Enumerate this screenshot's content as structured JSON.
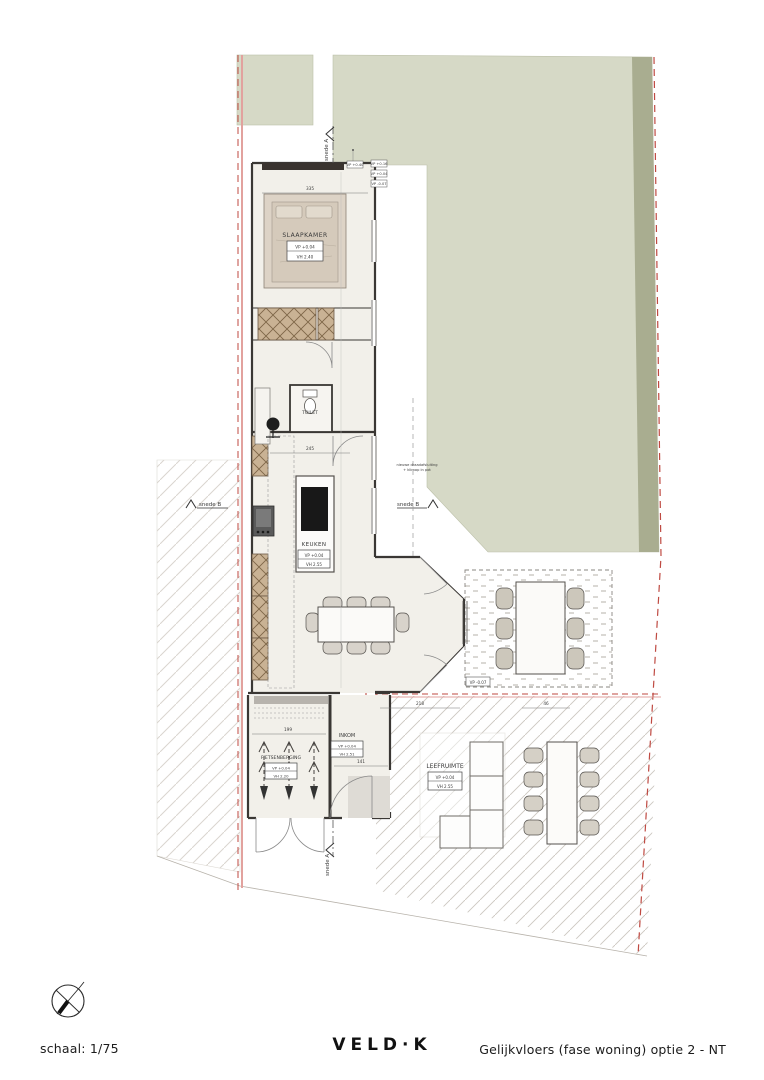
{
  "footer": {
    "scale_label": "schaal: 1/75",
    "logo": "VELD·K",
    "drawing_title": "Gelijkvloers (fase woning) optie 2 - NT"
  },
  "plan": {
    "rooms": {
      "slaapkamer": {
        "name": "SLAAPKAMER",
        "vp": "VP +0.04",
        "vh": "VH 2.40"
      },
      "toilet": {
        "name": "TOILET"
      },
      "keuken": {
        "name": "KEUKEN",
        "vp": "VP +0.04",
        "vh": "VH 2.55"
      },
      "inkom": {
        "name": "INKOM",
        "vp": "VP +0.04",
        "vh": "VH 2.51"
      },
      "fietsenberging": {
        "name": "FIETSENBERGING",
        "vp": "VP +0.04",
        "vh": "VH 2.20"
      },
      "leefruimte": {
        "name": "LEEFRUIMTE",
        "vp": "VP +0.04",
        "vh": "VH 2.55"
      }
    },
    "section_markers": {
      "snede_a": "snede A",
      "snede_b": "snede B"
    },
    "level_tags": {
      "t1": "VP +0.40",
      "t2": "VP +0.16",
      "t3": "VP +0.04",
      "t4": "VP -0.07",
      "terrace": "VP -0.07"
    },
    "annotations": {
      "fence_line1": "nieuwe draadafsluiting",
      "fence_line2": "+ klimop in pot"
    },
    "dimensions": {
      "d1": "335",
      "d2": "245",
      "d3": "199",
      "d4": "141",
      "d5": "218",
      "d6": "46"
    },
    "colors": {
      "garden": "#d6d9c6",
      "garden_dark": "#a9ad90",
      "boundary_red": "#bf4a42",
      "boundary_pink": "#e2a29e",
      "wall": "#3a3734"
    }
  }
}
